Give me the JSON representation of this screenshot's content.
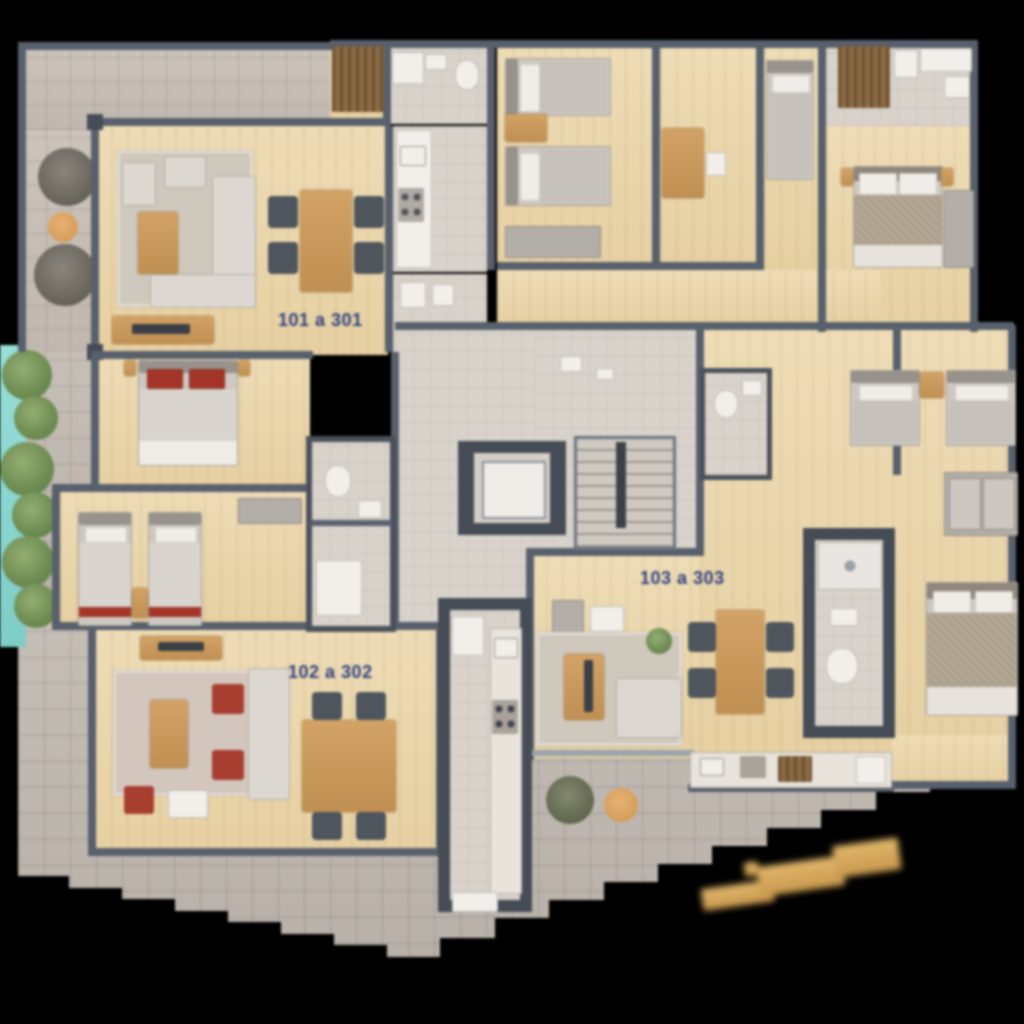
{
  "plan": {
    "description": "apartment building floor plan",
    "unit_labels": [
      {
        "id": "unit-101",
        "text": "101 a 301"
      },
      {
        "id": "unit-102",
        "text": "102 a 302"
      },
      {
        "id": "unit-103",
        "text": "103 a 303"
      }
    ],
    "label_color": "#2e4080"
  },
  "colors": {
    "background": "#000000",
    "wall": "#57606c",
    "wood_floor": "#ead6ab",
    "paver_terrace": "#beb7af",
    "bathroom_tile": "#d8d2cb",
    "water_feature": "#8ed8d2",
    "tree_green": "#6d8c52",
    "furniture_wood": "#c9995c",
    "chair_dark": "#4e555c",
    "accent_red": "#a83e30",
    "watermark_gold": "#d9ae62"
  },
  "icons": {
    "watermark": "gold-signature-watermark"
  }
}
